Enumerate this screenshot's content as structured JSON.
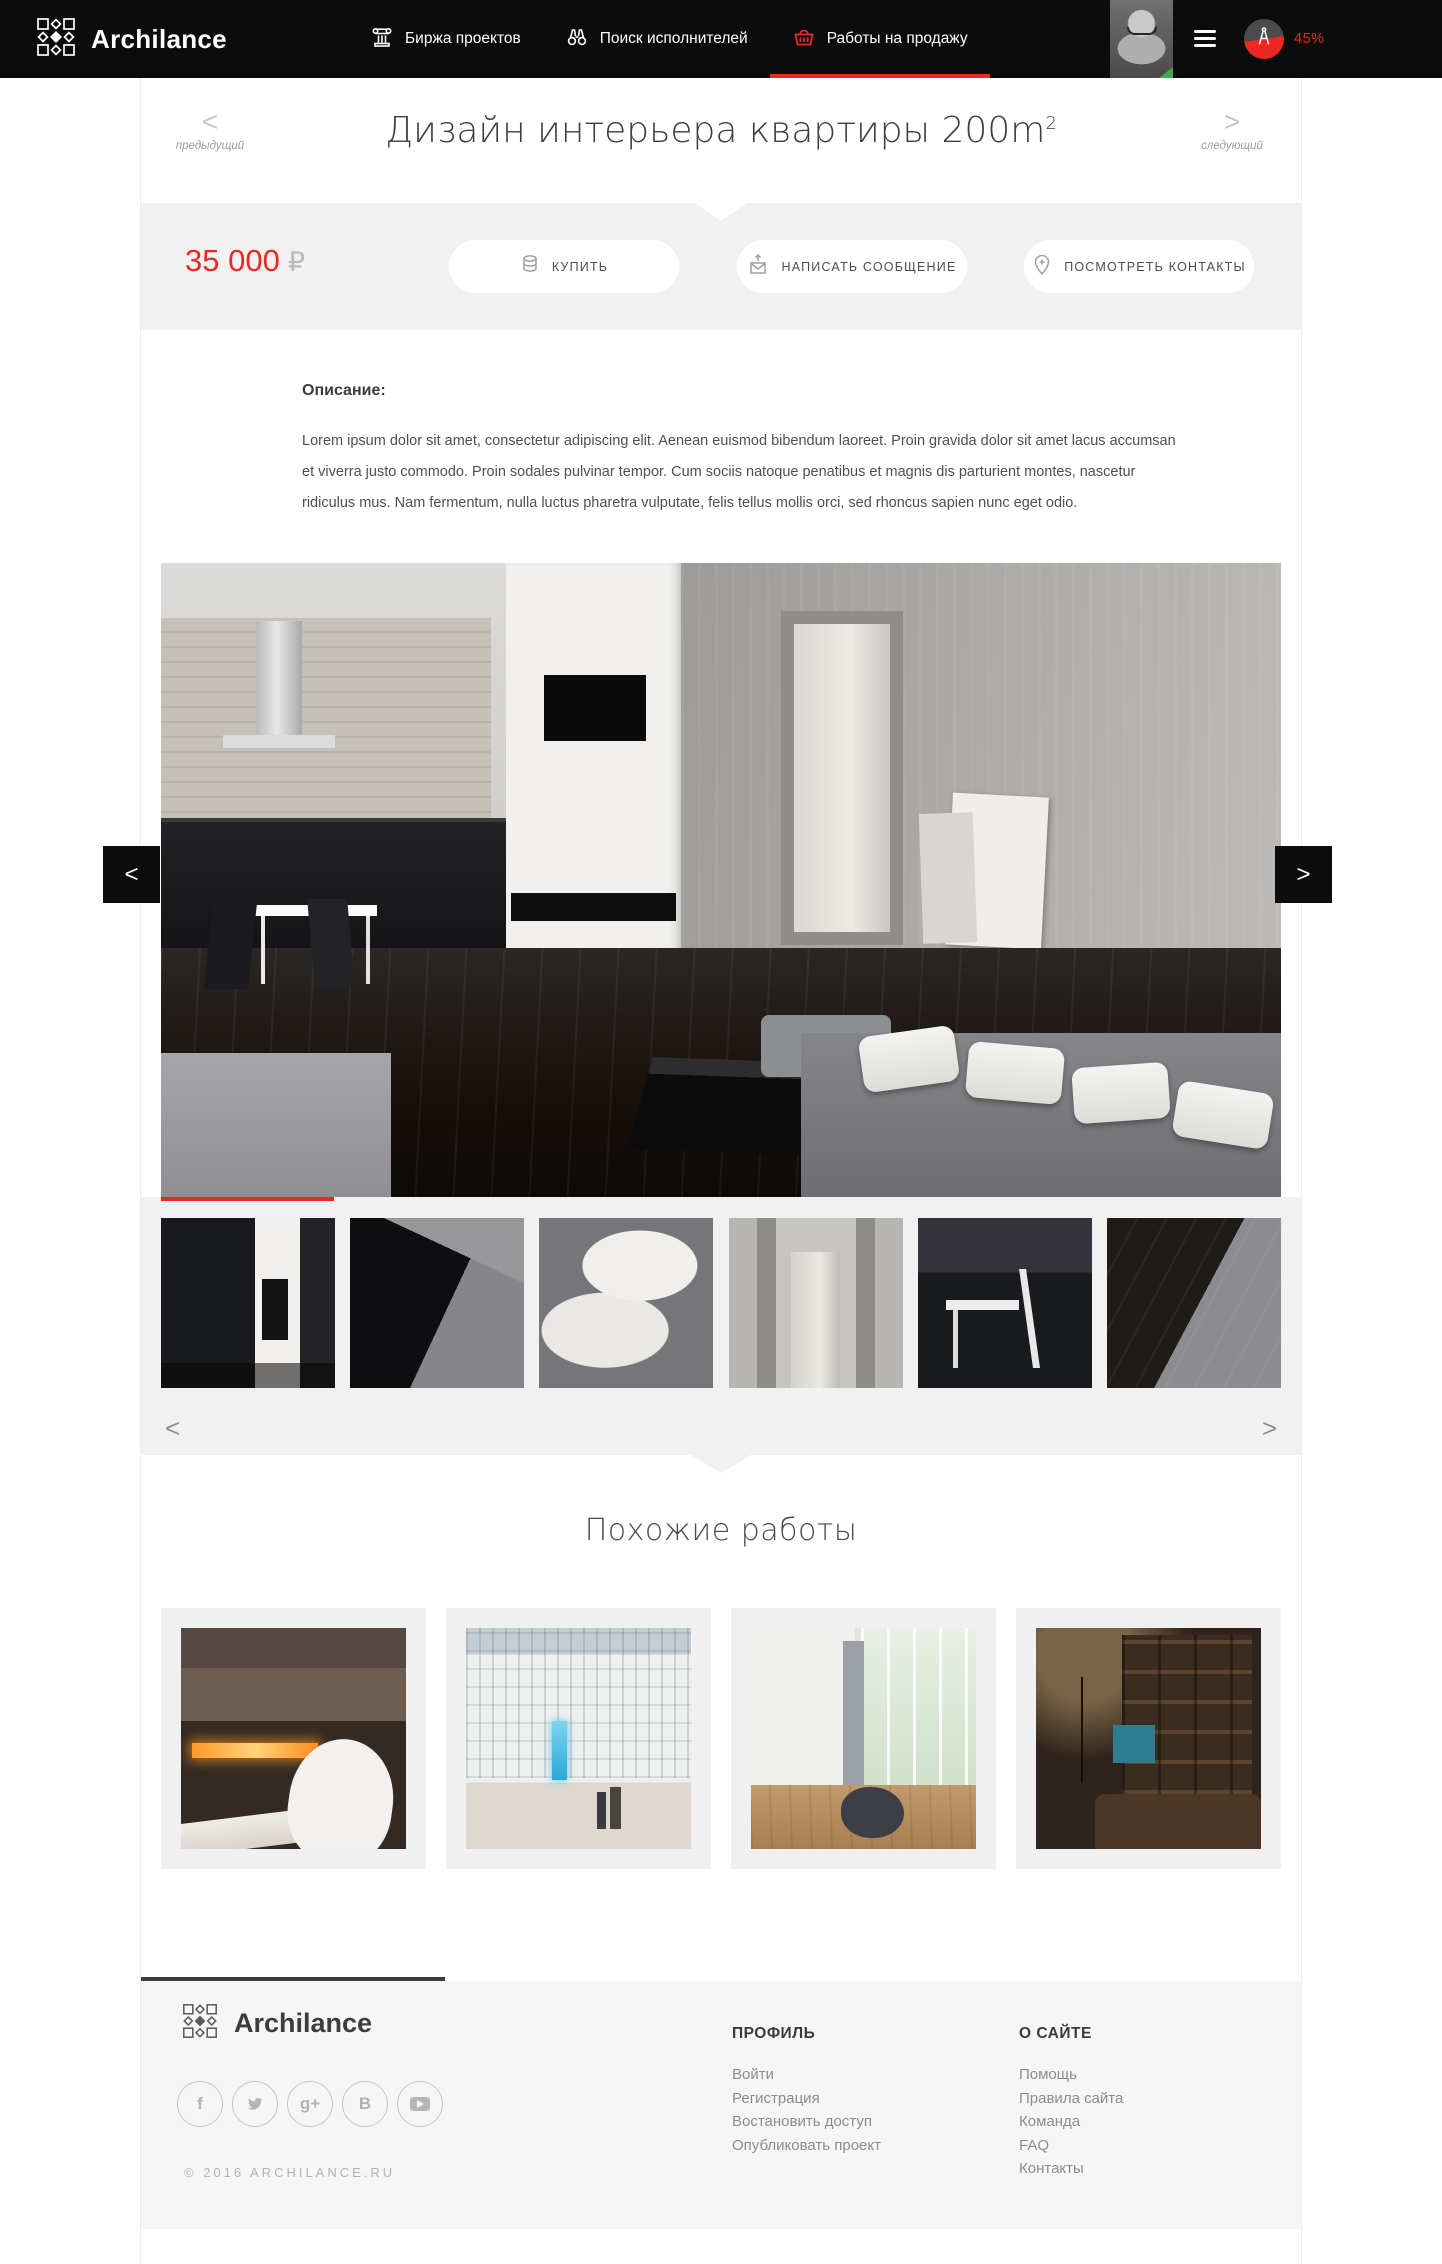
{
  "accent_color": "#ee2722",
  "nav": {
    "brand": "Archilance",
    "items": [
      {
        "label": "Биржа проектов"
      },
      {
        "label": "Поиск исполнителей"
      },
      {
        "label": "Работы на продажу"
      }
    ],
    "progress": "45%"
  },
  "title_bar": {
    "title": "Дизайн интерьера квартиры 200m",
    "title_sup": "2",
    "prev_arrow": "<",
    "prev_label": "предыдущий",
    "next_arrow": ">",
    "next_label": "следующий"
  },
  "purchase": {
    "price": "35 000",
    "currency": "₽",
    "buy_label": "КУПИТЬ",
    "message_label": "НАПИСАТЬ СООБЩЕНИЕ",
    "contacts_label": "ПОСМОТРЕТЬ КОНТАКТЫ"
  },
  "description": {
    "heading": "Описание:",
    "text": "Lorem ipsum dolor sit amet, consectetur adipiscing elit. Aenean euismod bibendum laoreet. Proin gravida dolor sit amet lacus accumsan et viverra justo commodo. Proin sodales pulvinar tempor. Cum sociis natoque penatibus et magnis dis parturient montes, nascetur ridiculus mus. Nam fermentum, nulla luctus pharetra vulputate, felis tellus mollis orci, sed rhoncus sapien nunc eget odio."
  },
  "gallery": {
    "prev_arrow": "<",
    "next_arrow": ">",
    "thumb_prev": "<",
    "thumb_next": ">",
    "thumbnails": [
      "kitchen-wall-tv",
      "black-coffee-table",
      "sofa-pillows",
      "concrete-doorway",
      "white-table-chair",
      "dark-floor-sofa"
    ]
  },
  "similar": {
    "heading": "Похожие работы",
    "items": [
      "fireplace-interior",
      "mall-atrium",
      "bright-living-room",
      "home-library"
    ]
  },
  "footer": {
    "brand": "Archilance",
    "copyright": "© 2016 ARCHILANCE.RU",
    "columns": [
      {
        "heading": "ПРОФИЛЬ",
        "links": [
          "Войти",
          "Регистрация",
          "Востановить доступ",
          "Опубликовать проект"
        ]
      },
      {
        "heading": "О САЙТЕ",
        "links": [
          "Помощь",
          "Правила сайта",
          "Команда",
          "FAQ",
          "Контакты"
        ]
      }
    ],
    "socials": [
      {
        "name": "facebook",
        "glyph": "f"
      },
      {
        "name": "twitter",
        "glyph": ""
      },
      {
        "name": "google-plus",
        "glyph": "g+"
      },
      {
        "name": "vk",
        "glyph": "В"
      },
      {
        "name": "youtube",
        "glyph": ""
      }
    ]
  }
}
